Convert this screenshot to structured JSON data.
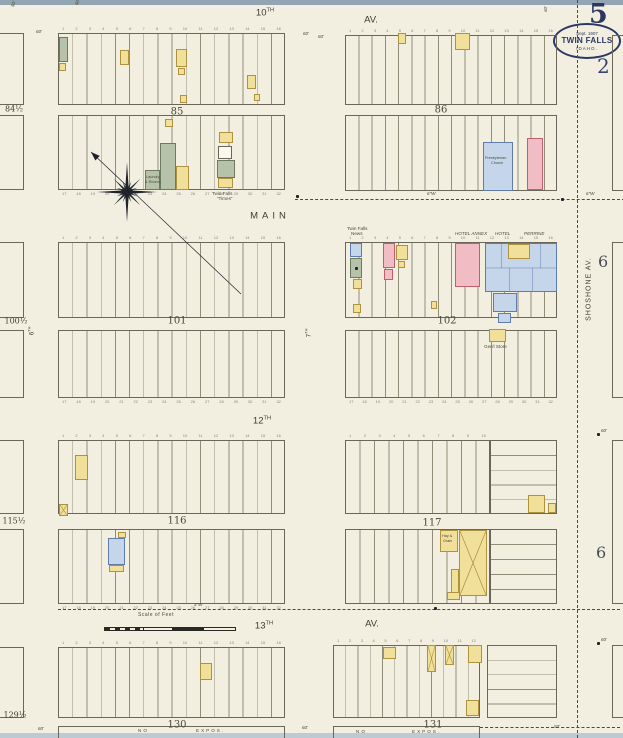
{
  "header": {
    "sheet_number": "5",
    "sub_number": "2",
    "stamp": {
      "date": "Sept. 1907",
      "city": "TWIN FALLS",
      "state": "IDAHO."
    }
  },
  "margin": {
    "numbers": [
      "6",
      "6"
    ]
  },
  "scale": {
    "label": "Scale of Feet"
  },
  "colors": {
    "paper": "#f2efe1",
    "line": "#908d79",
    "border": "#6a675a",
    "ink": "#4c4939",
    "navy": "#2c3763",
    "dash": "#4a4a42",
    "dot": "#1f232b",
    "numeral": "#8a8674",
    "yellow": "#f1e09a",
    "yellowBorder": "#ad923f",
    "pink": "#f2bcc4",
    "pinkBorder": "#c25f6e",
    "blue": "#c6d6ea",
    "blueBorder": "#5f7cad",
    "green": "#b7c2aa",
    "greenBorder": "#6e7a60",
    "white": "#faf7ec"
  },
  "map": {
    "lot_numbers": {
      "n1_16": [
        "1",
        "2",
        "3",
        "4",
        "5",
        "6",
        "7",
        "8",
        "9",
        "10",
        "11",
        "12",
        "13",
        "14",
        "15",
        "16"
      ],
      "n17_32": [
        "17",
        "18",
        "19",
        "20",
        "21",
        "22",
        "23",
        "24",
        "25",
        "26",
        "27",
        "28",
        "29",
        "30",
        "31",
        "32"
      ],
      "n1_10": [
        "1",
        "2",
        "3",
        "4",
        "5",
        "6",
        "7",
        "8",
        "9",
        "10"
      ],
      "n1_12": [
        "1",
        "2",
        "3",
        "4",
        "5",
        "6",
        "7",
        "8",
        "9",
        "10",
        "11",
        "12"
      ]
    },
    "blocks": [
      {
        "name": "block-85-north",
        "x": 58,
        "y": 33,
        "w": 227,
        "h": 72,
        "dir": "v",
        "lots": 16,
        "numsTop": "n1_16"
      },
      {
        "name": "block-85-south",
        "x": 58,
        "y": 115,
        "w": 227,
        "h": 75,
        "dir": "v",
        "lots": 16,
        "numsBottom": "n17_32"
      },
      {
        "name": "block-86-north",
        "x": 345,
        "y": 35,
        "w": 212,
        "h": 70,
        "dir": "v",
        "lots": 16,
        "numsTop": "n1_16"
      },
      {
        "name": "block-86-south",
        "x": 345,
        "y": 115,
        "w": 212,
        "h": 76,
        "dir": "v",
        "lots": 16
      },
      {
        "name": "block-101-north",
        "x": 58,
        "y": 242,
        "w": 227,
        "h": 76,
        "dir": "v",
        "lots": 16,
        "numsTop": "n1_16"
      },
      {
        "name": "block-101-south",
        "x": 58,
        "y": 330,
        "w": 227,
        "h": 68,
        "dir": "v",
        "lots": 16,
        "numsBottom": "n17_32"
      },
      {
        "name": "block-102-north",
        "x": 345,
        "y": 242,
        "w": 212,
        "h": 76,
        "dir": "v",
        "lots": 16,
        "numsTop": "n1_16"
      },
      {
        "name": "block-102-south",
        "x": 345,
        "y": 330,
        "w": 212,
        "h": 68,
        "dir": "v",
        "lots": 16,
        "numsBottom": "n17_32"
      },
      {
        "name": "block-116-north",
        "x": 58,
        "y": 440,
        "w": 227,
        "h": 74,
        "dir": "v",
        "lots": 16,
        "numsTop": "n1_16"
      },
      {
        "name": "block-116-south",
        "x": 58,
        "y": 529,
        "w": 227,
        "h": 75,
        "dir": "v",
        "lots": 16,
        "numsBottom": "n17_32"
      },
      {
        "name": "block-117-northwest",
        "x": 345,
        "y": 440,
        "w": 145,
        "h": 74,
        "dir": "v",
        "lots": 10,
        "numsTop": "n1_10"
      },
      {
        "name": "block-117-northeast",
        "x": 490,
        "y": 440,
        "w": 67,
        "h": 74,
        "dir": "h",
        "lots": 5
      },
      {
        "name": "block-117-southwest",
        "x": 345,
        "y": 529,
        "w": 145,
        "h": 75,
        "dir": "v",
        "lots": 10
      },
      {
        "name": "block-117-southeast",
        "x": 490,
        "y": 529,
        "w": 67,
        "h": 75,
        "dir": "h",
        "lots": 5
      },
      {
        "name": "block-130",
        "x": 58,
        "y": 647,
        "w": 227,
        "h": 71,
        "dir": "v",
        "lots": 16,
        "numsTop": "n1_16"
      },
      {
        "name": "block-131",
        "x": 333,
        "y": 645,
        "w": 147,
        "h": 73,
        "dir": "v",
        "lots": 12,
        "numsTop": "n1_12"
      },
      {
        "name": "block-131-east",
        "x": 487,
        "y": 645,
        "w": 70,
        "h": 73,
        "dir": "h",
        "lots": 5
      }
    ],
    "partial_blocks": [
      {
        "x": -6,
        "y": 33,
        "w": 30,
        "h": 72
      },
      {
        "x": -6,
        "y": 115,
        "w": 30,
        "h": 75
      },
      {
        "x": -6,
        "y": 242,
        "w": 30,
        "h": 76
      },
      {
        "x": -6,
        "y": 330,
        "w": 30,
        "h": 68
      },
      {
        "x": -6,
        "y": 440,
        "w": 30,
        "h": 74
      },
      {
        "x": -6,
        "y": 529,
        "w": 30,
        "h": 75
      },
      {
        "x": -6,
        "y": 647,
        "w": 30,
        "h": 71
      },
      {
        "x": 612,
        "y": 35,
        "w": 16,
        "h": 156
      },
      {
        "x": 612,
        "y": 242,
        "w": 16,
        "h": 156
      },
      {
        "x": 612,
        "y": 440,
        "w": 16,
        "h": 164
      },
      {
        "x": 612,
        "y": 645,
        "w": 16,
        "h": 73
      }
    ],
    "strips": [
      {
        "x": 58,
        "y": 726,
        "w": 227,
        "h": 14
      },
      {
        "x": 333,
        "y": 726,
        "w": 147,
        "h": 14
      }
    ],
    "block_labels": [
      {
        "t": "85",
        "x": 177,
        "y": 112
      },
      {
        "t": "86",
        "x": 441,
        "y": 110
      },
      {
        "t": "101",
        "x": 177,
        "y": 321
      },
      {
        "t": "102",
        "x": 447,
        "y": 321
      },
      {
        "t": "116",
        "x": 177,
        "y": 521
      },
      {
        "t": "117",
        "x": 432,
        "y": 523
      },
      {
        "t": "130",
        "x": 177,
        "y": 725
      },
      {
        "t": "131",
        "x": 433,
        "y": 725
      }
    ],
    "edge_labels": [
      {
        "t": "84½",
        "x": 14,
        "y": 109
      },
      {
        "t": "100½",
        "x": 16,
        "y": 321
      },
      {
        "t": "115½",
        "x": 14,
        "y": 521
      },
      {
        "t": "129½",
        "x": 15,
        "y": 715
      }
    ],
    "street_labels": [
      {
        "t": "10",
        "sup": "TH",
        "x": 265,
        "y": 13
      },
      {
        "t": "AV.",
        "x": 371,
        "y": 20
      },
      {
        "t": "MAIN",
        "x": 270,
        "y": 216,
        "ls": 4
      },
      {
        "t": "12",
        "sup": "TH",
        "x": 262,
        "y": 421
      },
      {
        "t": "13",
        "sup": "TH",
        "x": 264,
        "y": 626
      },
      {
        "t": "AV.",
        "x": 372,
        "y": 624
      },
      {
        "t": "SHOSHONE   AV.",
        "x": 589,
        "y": 289,
        "rot": -90,
        "s": 7,
        "ls": 1
      },
      {
        "t": "6",
        "sup": "TH",
        "x": 31,
        "y": 331,
        "rot": -90,
        "s": 6.5
      },
      {
        "t": "7",
        "sup": "TH",
        "x": 308,
        "y": 333,
        "rot": -90,
        "s": 6.5
      }
    ],
    "buildings": [
      {
        "x": 59,
        "y": 37,
        "w": 9,
        "h": 25,
        "c": "g",
        "n": "store-building"
      },
      {
        "x": 59,
        "y": 63,
        "w": 7,
        "h": 8,
        "c": "y",
        "n": "outbuilding"
      },
      {
        "x": 120,
        "y": 50,
        "w": 9,
        "h": 15,
        "c": "y",
        "n": "dwelling"
      },
      {
        "x": 176,
        "y": 49,
        "w": 11,
        "h": 18,
        "c": "y",
        "n": "dwelling"
      },
      {
        "x": 178,
        "y": 68,
        "w": 7,
        "h": 7,
        "c": "y",
        "n": "outbuilding"
      },
      {
        "x": 247,
        "y": 75,
        "w": 9,
        "h": 14,
        "c": "y",
        "n": "dwelling"
      },
      {
        "x": 180,
        "y": 95,
        "w": 7,
        "h": 8,
        "c": "y",
        "n": "outbuilding"
      },
      {
        "x": 254,
        "y": 94,
        "w": 6,
        "h": 7,
        "c": "y",
        "n": "outbuilding"
      },
      {
        "x": 165,
        "y": 119,
        "w": 8,
        "h": 8,
        "c": "y",
        "n": "outbuilding"
      },
      {
        "x": 160,
        "y": 143,
        "w": 16,
        "h": 47,
        "c": "g",
        "n": "laundry-building"
      },
      {
        "x": 145,
        "y": 170,
        "w": 15,
        "h": 20,
        "c": "g",
        "n": "laundry-building"
      },
      {
        "x": 176,
        "y": 166,
        "w": 13,
        "h": 24,
        "c": "y",
        "n": "dwelling"
      },
      {
        "x": 219,
        "y": 132,
        "w": 14,
        "h": 11,
        "c": "y",
        "n": "outbuilding"
      },
      {
        "x": 218,
        "y": 146,
        "w": 14,
        "h": 13,
        "c": "w",
        "n": "dwelling"
      },
      {
        "x": 217,
        "y": 160,
        "w": 18,
        "h": 18,
        "c": "g",
        "n": "twin-falls-times-office"
      },
      {
        "x": 218,
        "y": 178,
        "w": 15,
        "h": 10,
        "c": "y",
        "n": "outbuilding"
      },
      {
        "x": 398,
        "y": 33,
        "w": 8,
        "h": 11,
        "c": "y",
        "n": "dwelling"
      },
      {
        "x": 455,
        "y": 33,
        "w": 15,
        "h": 17,
        "c": "y",
        "n": "store-building"
      },
      {
        "x": 483,
        "y": 142,
        "w": 30,
        "h": 49,
        "c": "b",
        "n": "presbyterian-church"
      },
      {
        "x": 527,
        "y": 138,
        "w": 16,
        "h": 52,
        "c": "p",
        "n": "hall-building"
      },
      {
        "x": 350,
        "y": 243,
        "w": 12,
        "h": 14,
        "c": "b",
        "n": "office-building"
      },
      {
        "x": 350,
        "y": 258,
        "w": 12,
        "h": 20,
        "c": "g",
        "n": "twin-falls-news-office"
      },
      {
        "x": 353,
        "y": 279,
        "w": 9,
        "h": 10,
        "c": "y",
        "n": "outbuilding"
      },
      {
        "x": 383,
        "y": 243,
        "w": 12,
        "h": 25,
        "c": "p",
        "n": "store-building"
      },
      {
        "x": 384,
        "y": 269,
        "w": 9,
        "h": 11,
        "c": "p",
        "n": "store-building"
      },
      {
        "x": 396,
        "y": 245,
        "w": 12,
        "h": 15,
        "c": "y",
        "n": "office-building"
      },
      {
        "x": 398,
        "y": 261,
        "w": 7,
        "h": 7,
        "c": "y",
        "n": "outbuilding"
      },
      {
        "x": 455,
        "y": 243,
        "w": 25,
        "h": 44,
        "c": "p",
        "n": "hotel-annex"
      },
      {
        "x": 485,
        "y": 243,
        "w": 72,
        "h": 49,
        "c": "b",
        "n": "hotel-perrine",
        "inner": 1
      },
      {
        "x": 508,
        "y": 244,
        "w": 22,
        "h": 15,
        "c": "y",
        "n": "hotel-courtyard"
      },
      {
        "x": 493,
        "y": 293,
        "w": 24,
        "h": 19,
        "c": "b",
        "n": "hotel-wing"
      },
      {
        "x": 498,
        "y": 313,
        "w": 13,
        "h": 10,
        "c": "b",
        "n": "hotel-outbuilding"
      },
      {
        "x": 353,
        "y": 304,
        "w": 8,
        "h": 9,
        "c": "y",
        "n": "outbuilding"
      },
      {
        "x": 431,
        "y": 301,
        "w": 6,
        "h": 8,
        "c": "y",
        "n": "outbuilding"
      },
      {
        "x": 489,
        "y": 329,
        "w": 17,
        "h": 13,
        "c": "y",
        "n": "genl-store"
      },
      {
        "x": 75,
        "y": 455,
        "w": 13,
        "h": 25,
        "c": "y",
        "n": "dwelling"
      },
      {
        "x": 59,
        "y": 504,
        "w": 9,
        "h": 12,
        "c": "y",
        "n": "stable",
        "cross": 1
      },
      {
        "x": 118,
        "y": 532,
        "w": 8,
        "h": 6,
        "c": "y",
        "n": "outbuilding"
      },
      {
        "x": 108,
        "y": 538,
        "w": 17,
        "h": 27,
        "c": "b",
        "n": "dwelling"
      },
      {
        "x": 109,
        "y": 565,
        "w": 15,
        "h": 7,
        "c": "y",
        "n": "outbuilding"
      },
      {
        "x": 528,
        "y": 495,
        "w": 17,
        "h": 18,
        "c": "y",
        "n": "dwelling"
      },
      {
        "x": 548,
        "y": 503,
        "w": 8,
        "h": 10,
        "c": "y",
        "n": "outbuilding"
      },
      {
        "x": 440,
        "y": 530,
        "w": 18,
        "h": 22,
        "c": "y",
        "n": "hay-grain-warehouse"
      },
      {
        "x": 459,
        "y": 530,
        "w": 28,
        "h": 66,
        "c": "y",
        "n": "lumber-shed",
        "cross": 1
      },
      {
        "x": 451,
        "y": 569,
        "w": 8,
        "h": 24,
        "c": "y",
        "n": "shed"
      },
      {
        "x": 447,
        "y": 592,
        "w": 13,
        "h": 8,
        "c": "y",
        "n": "shed"
      },
      {
        "x": 200,
        "y": 663,
        "w": 12,
        "h": 17,
        "c": "y",
        "n": "dwelling"
      },
      {
        "x": 383,
        "y": 647,
        "w": 13,
        "h": 12,
        "c": "y",
        "n": "dwelling"
      },
      {
        "x": 427,
        "y": 645,
        "w": 9,
        "h": 27,
        "c": "y",
        "n": "barn",
        "cross": 1
      },
      {
        "x": 445,
        "y": 645,
        "w": 9,
        "h": 20,
        "c": "y",
        "n": "barn",
        "cross": 1
      },
      {
        "x": 468,
        "y": 645,
        "w": 14,
        "h": 18,
        "c": "y",
        "n": "store-building"
      },
      {
        "x": 466,
        "y": 700,
        "w": 13,
        "h": 16,
        "c": "y",
        "n": "shed"
      }
    ],
    "tiny_labels": [
      {
        "t": "6\"W",
        "x": 427,
        "y": 191,
        "i": 1
      },
      {
        "t": "6\"W",
        "x": 586,
        "y": 191,
        "i": 1
      },
      {
        "t": "4\"W",
        "x": 194,
        "y": 602,
        "i": 1
      },
      {
        "t": "Twin Falls",
        "x": 212,
        "y": 191
      },
      {
        "t": "“Times”",
        "x": 217,
        "y": 196
      },
      {
        "t": "Twin Falls",
        "x": 347,
        "y": 226
      },
      {
        "t": "News",
        "x": 351,
        "y": 231
      },
      {
        "t": "HOTEL ANNEX",
        "x": 455,
        "y": 231,
        "i": 1
      },
      {
        "t": "HOTEL",
        "x": 495,
        "y": 231,
        "i": 1
      },
      {
        "t": "PERRINE",
        "x": 524,
        "y": 231,
        "i": 1
      },
      {
        "t": "Presbyterian",
        "x": 485,
        "y": 156,
        "s": 3.8
      },
      {
        "t": "Church",
        "x": 491,
        "y": 161,
        "s": 3.8
      },
      {
        "t": "Gen'l Store",
        "x": 484,
        "y": 344
      },
      {
        "t": "Hay &",
        "x": 442,
        "y": 534,
        "s": 3.8
      },
      {
        "t": "Grain",
        "x": 443,
        "y": 539,
        "s": 3.8
      },
      {
        "t": "Laundry",
        "x": 146,
        "y": 175,
        "s": 3.8
      },
      {
        "t": "& Rooms",
        "x": 145,
        "y": 180,
        "s": 3.8
      },
      {
        "t": "60'",
        "x": 36,
        "y": 29,
        "i": 1
      },
      {
        "t": "60'",
        "x": 303,
        "y": 31,
        "i": 1
      },
      {
        "t": "60'",
        "x": 318,
        "y": 34,
        "i": 1
      },
      {
        "t": "60'",
        "x": 38,
        "y": 726,
        "i": 1
      },
      {
        "t": "60'",
        "x": 302,
        "y": 725,
        "i": 1
      },
      {
        "t": "50'",
        "x": 554,
        "y": 724,
        "i": 1
      },
      {
        "t": "50'",
        "x": 10,
        "y": 6,
        "rot": -70,
        "i": 1
      },
      {
        "t": "60'",
        "x": 74,
        "y": 4,
        "rot": -70,
        "i": 1
      },
      {
        "t": "60'",
        "x": 543,
        "y": 12,
        "rot": -90,
        "i": 1
      },
      {
        "t": "60'",
        "x": 601,
        "y": 428,
        "i": 1
      },
      {
        "t": "60'",
        "x": 601,
        "y": 637,
        "i": 1
      },
      {
        "t": "NO",
        "x": 138,
        "y": 728,
        "ls": 2
      },
      {
        "t": "EXPOS.",
        "x": 196,
        "y": 728,
        "ls": 2
      },
      {
        "t": "NO",
        "x": 356,
        "y": 729,
        "ls": 2
      },
      {
        "t": "EXPOS.",
        "x": 412,
        "y": 729,
        "ls": 2
      }
    ],
    "dots": [
      [
        297,
        196
      ],
      [
        562,
        199
      ],
      [
        598,
        434
      ],
      [
        598,
        643
      ],
      [
        435,
        608
      ],
      [
        356,
        268
      ]
    ],
    "dashes": [
      {
        "x": 295,
        "y": 199,
        "len": 330,
        "dir": "h"
      },
      {
        "x": 58,
        "y": 609,
        "len": 562,
        "dir": "h"
      },
      {
        "x": 480,
        "y": 727,
        "len": 140,
        "dir": "h"
      },
      {
        "x": 577,
        "y": 0,
        "len": 738,
        "dir": "v"
      }
    ],
    "compass": {
      "cx": 127,
      "cy": 192,
      "tip": [
        91,
        152
      ],
      "tail": [
        241,
        294
      ]
    }
  }
}
